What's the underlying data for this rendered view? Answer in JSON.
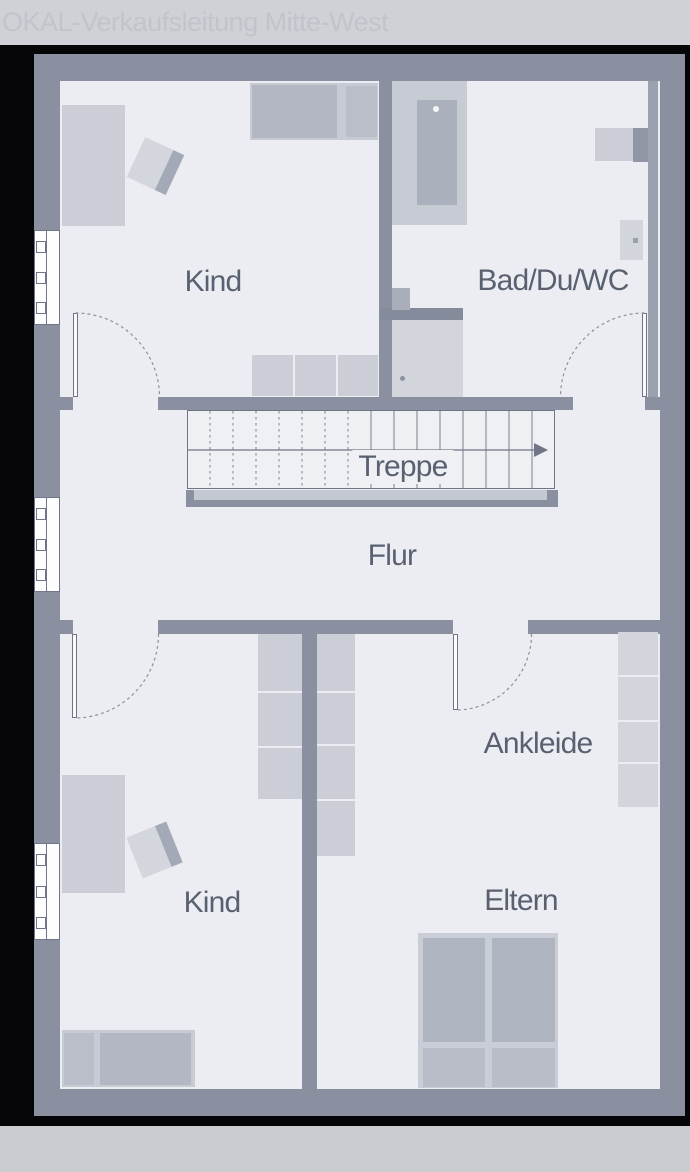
{
  "watermark": "OKAL-Verkaufsleitung Mitte-West",
  "plan": {
    "type": "floor-plan-upper-storey",
    "labels": {
      "kind_top": "Kind",
      "bad": "Bad/Du/WC",
      "treppe": "Treppe",
      "flur": "Flur",
      "ankleide": "Ankleide",
      "kind_bottom": "Kind",
      "eltern": "Eltern"
    },
    "colors": {
      "background": "#050507",
      "wall": "#8a90a0",
      "floor": "#ecedf2",
      "furniture_light": "#cbced7",
      "furniture_dark": "#b2b7c3",
      "label_text": "#596170",
      "watermark_band": "#d0d1d6",
      "watermark_text": "#c2c4cc"
    }
  }
}
